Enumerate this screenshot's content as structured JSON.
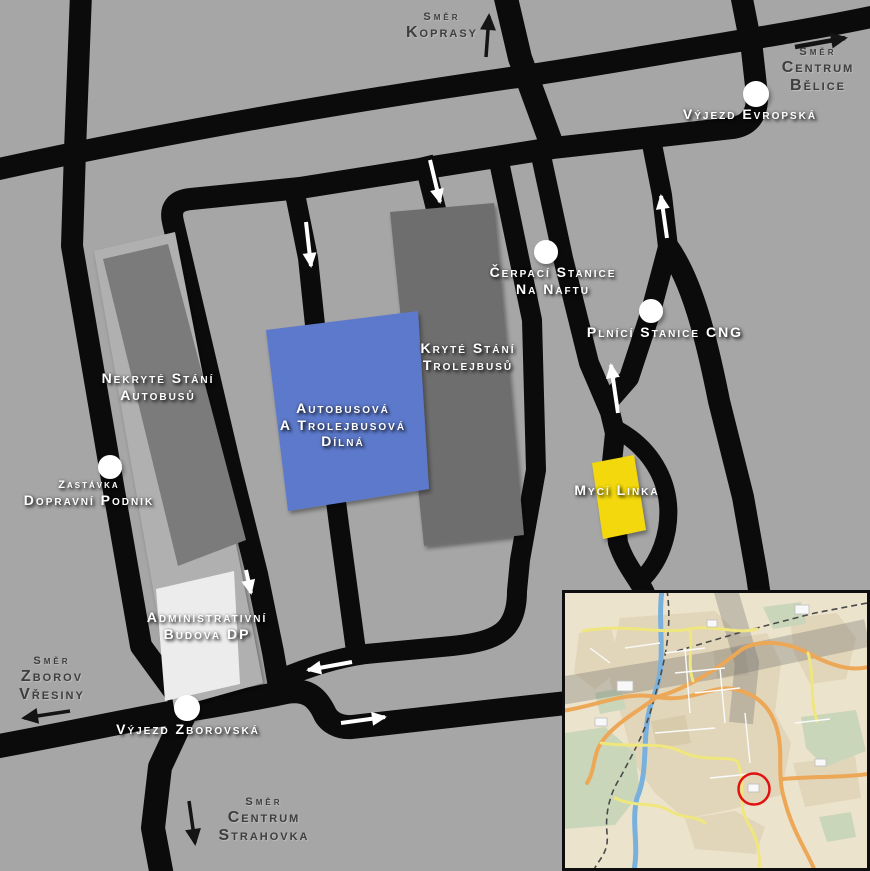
{
  "title": "Depot schematic map",
  "colors": {
    "background": "#a6a6a6",
    "road": "#0b0b0b",
    "plot": "#b0b0b0",
    "marker_dot": "#ffffff",
    "label_white": "#ffffff",
    "label_dark": "#3e3e3e"
  },
  "facilities": {
    "nekryte": {
      "line1": "Nekryté Stání",
      "line2": "Autobusů",
      "color": "#7b7b7b"
    },
    "kryte": {
      "line1": "Kryté Stání",
      "line2": "Trolejbusů",
      "color": "#6e6e6e"
    },
    "dilna": {
      "line1": "Autobusová",
      "line2": "A Trolejbusová",
      "line3": "Dílná",
      "color": "#5b79cb"
    },
    "admin": {
      "line1": "Administrativní",
      "line2": "Budova DP",
      "color": "#ececec"
    },
    "myci": {
      "line1": "Mycí Linka",
      "color": "#f2d808"
    }
  },
  "markers": {
    "dot_color": "#ffffff",
    "evropska": {
      "label": "Výjezd Evropská"
    },
    "cerpaci": {
      "line1": "Čerpací Stanice",
      "line2": "Na Naftu"
    },
    "cng": {
      "label": "Plnící Stanice CNG"
    },
    "zastavka": {
      "line1": "Zastávka",
      "line2": "Dopravní Podnik"
    },
    "zborovska": {
      "label": "Výjezd Zborovská"
    }
  },
  "directions": {
    "koprasy": {
      "line1": "Směr",
      "line2": "Koprasy"
    },
    "belice": {
      "line1": "Směr",
      "line2": "Centrum",
      "line3": "Bělice"
    },
    "zborov": {
      "line1": "Směr",
      "line2": "Zborov",
      "line3": "Vřesiny"
    },
    "strahovka": {
      "line1": "Směr",
      "line2": "Centrum",
      "line3": "Strahovka"
    }
  },
  "inset": {
    "highlight_color": "#e01212"
  }
}
